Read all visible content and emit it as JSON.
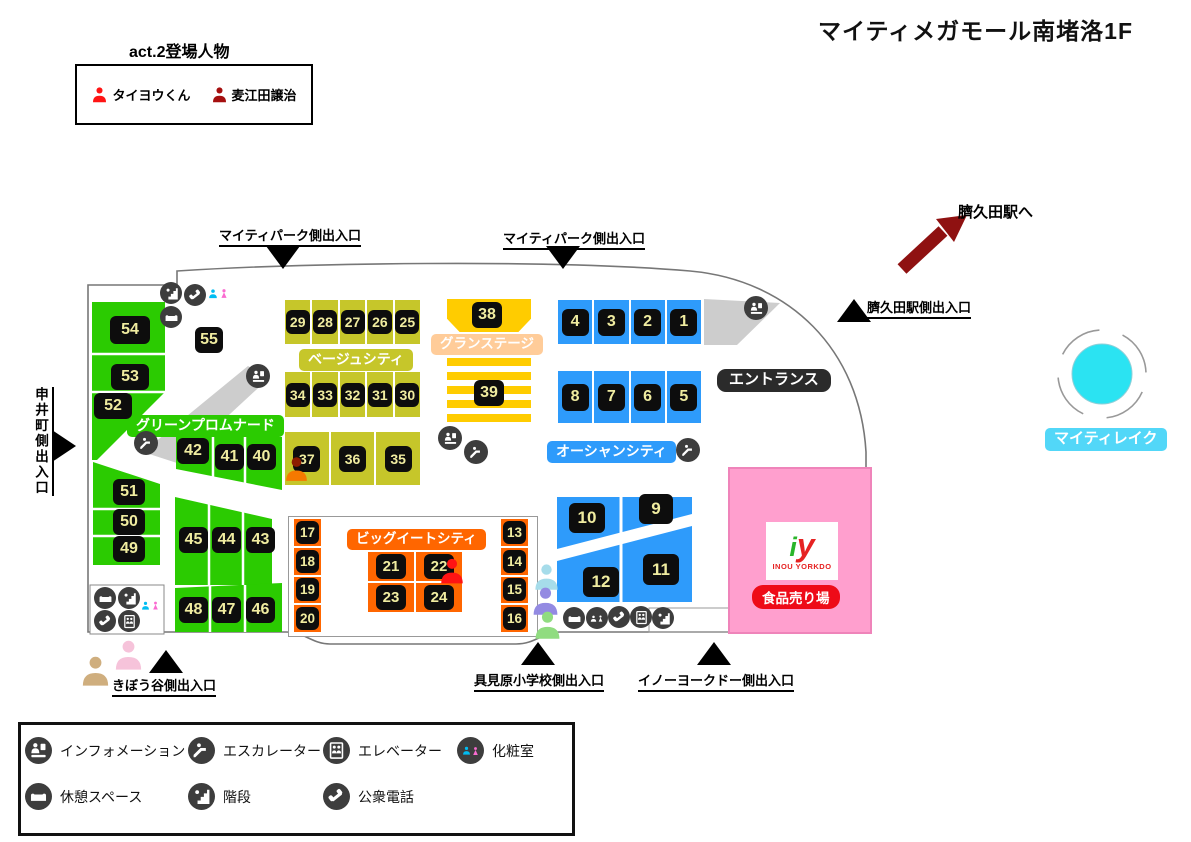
{
  "title": "マイティメガモール南堵洛1F",
  "cast": {
    "title": "act.2登場人物",
    "members": [
      {
        "name": "タイヨウくん",
        "color": "#ff1414"
      },
      {
        "name": "麦江田譲治",
        "color": "#a50f0f"
      }
    ]
  },
  "station": {
    "direction_label": "臍久田駅へ"
  },
  "lake": {
    "label": "マイティレイク"
  },
  "entrance": {
    "label": "エントランス"
  },
  "exits": {
    "mighty_park": "マイティパーク側出入口",
    "hesokuda_station": "臍久田駅側出入口",
    "saruimachi": "申井町側出入口",
    "kibou_valley": "きぼう谷側出入口",
    "gumihara_school": "具見原小学校側出入口",
    "inou_yorkdo": "イノーヨークドー側出入口"
  },
  "zones": {
    "green": {
      "label": "グリーンプロムナード",
      "tiles": {
        "c54": [
          "54",
          "53",
          "52"
        ],
        "c51": [
          "51",
          "50",
          "49"
        ],
        "r42": [
          "42",
          "41",
          "40"
        ],
        "r45": [
          "45",
          "44",
          "43"
        ],
        "r48": [
          "48",
          "47",
          "46"
        ],
        "solo": "55"
      }
    },
    "beige": {
      "label": "ベージュシティ",
      "row1": [
        "29",
        "28",
        "27",
        "26",
        "25"
      ],
      "row2": [
        "34",
        "33",
        "32",
        "31",
        "30"
      ],
      "row3": [
        "37",
        "36",
        "35"
      ]
    },
    "stage": {
      "label": "グランステージ",
      "block": "38",
      "stripe_block": "39"
    },
    "ocean": {
      "label": "オーシャンシティ",
      "row1": [
        "4",
        "3",
        "2",
        "1"
      ],
      "row2": [
        "8",
        "7",
        "6",
        "5"
      ],
      "block10": "10",
      "block9": "9",
      "block12": "12",
      "block11": "11"
    },
    "bigeat": {
      "label": "ビッグイートシティ",
      "left": [
        "17",
        "18",
        "19",
        "20"
      ],
      "right": [
        "13",
        "14",
        "15",
        "16"
      ],
      "center": [
        "21",
        "22",
        "23",
        "24"
      ]
    },
    "food": {
      "logo_mark_i": "i",
      "logo_mark_y": "y",
      "store_name": "INOU YORKDO",
      "label": "食品売り場"
    }
  },
  "legend": {
    "items": [
      {
        "icon": "information",
        "label": "インフォメーション"
      },
      {
        "icon": "escalator",
        "label": "エスカレーター"
      },
      {
        "icon": "elevator",
        "label": "エレベーター"
      },
      {
        "icon": "restroom",
        "label": "化粧室"
      },
      {
        "icon": "rest-space",
        "label": "休憩スペース"
      },
      {
        "icon": "stairs",
        "label": "階段"
      },
      {
        "icon": "phone",
        "label": "公衆電話"
      }
    ]
  },
  "markers": [
    {
      "id": "red-person",
      "color": "#ff1414"
    },
    {
      "id": "orange-person",
      "color": "#f57900",
      "head_color": "#8c1c00"
    },
    {
      "id": "cyan-person",
      "color": "#a6dcea"
    },
    {
      "id": "purple-person",
      "color": "#938ae2"
    },
    {
      "id": "green-person",
      "color": "#90dc80"
    },
    {
      "id": "pink-person",
      "color": "#f6c3da"
    },
    {
      "id": "tan-person",
      "color": "#cfae7e"
    }
  ],
  "colors": {
    "green": "#2bcb01",
    "beige": "#c6c62a",
    "gold": "#ffcc00",
    "peach": "#ffcc99",
    "blue": "#2e9bfb",
    "orange": "#ff6600",
    "pink": "#ff9fce",
    "pinkbd": "#ef84ba",
    "foodred": "#ee0b18",
    "lake": "#2be3f2",
    "lakelabel": "#52d7f8",
    "dark": "#2b2b2b",
    "icondark": "#3d3d3d",
    "arrow": "#8f1111",
    "tiletext": "#f0eca0",
    "wcm": "#00bdf2",
    "wcf": "#fa6bd0",
    "logogreen": "#2ab52a",
    "logored": "#e62222",
    "gray": "#cdcdcd"
  }
}
